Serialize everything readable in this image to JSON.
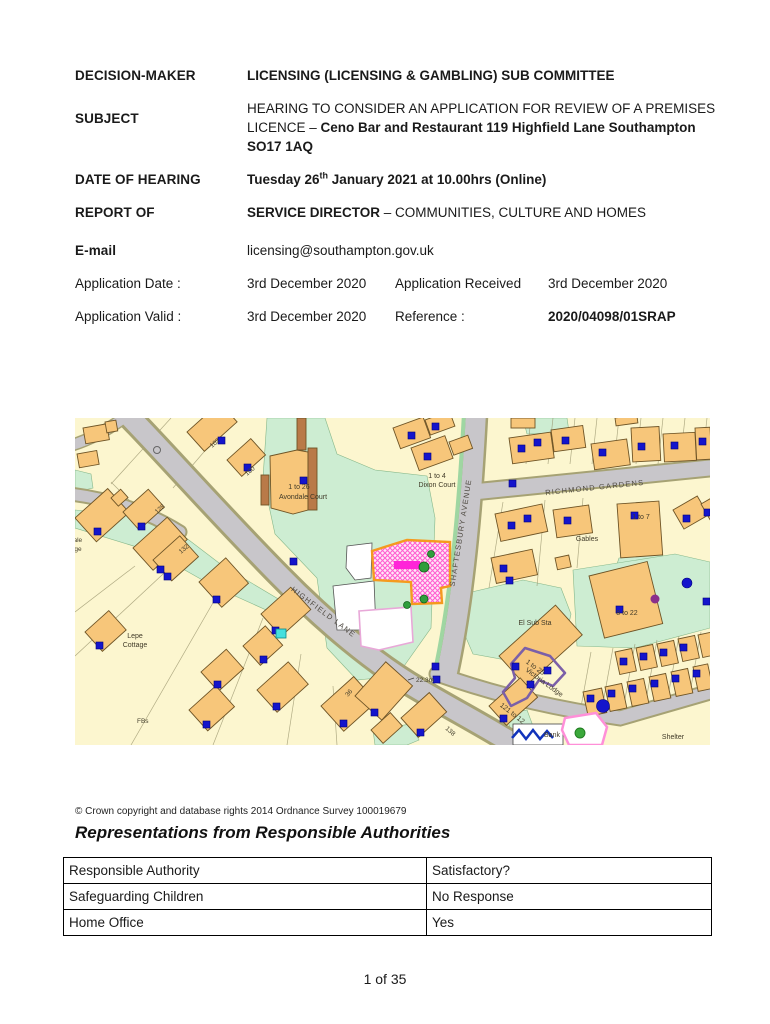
{
  "header": {
    "decision_maker_label": "DECISION-MAKER",
    "decision_maker_value": "LICENSING (LICENSING & GAMBLING) SUB COMMITTEE",
    "subject_label": "SUBJECT",
    "subject_value_regular": "HEARING TO CONSIDER AN APPLICATION FOR REVIEW OF A PREMISES LICENCE – ",
    "subject_value_bold": "Ceno Bar and Restaurant 119 Highfield Lane Southampton SO17 1AQ",
    "date_label": "DATE OF HEARING",
    "date_value_main": "Tuesday 26",
    "date_value_sup": "th",
    "date_value_rest": " January 2021 at 10.00hrs (Online)",
    "report_label": "REPORT OF",
    "report_value_bold": "SERVICE DIRECTOR",
    "report_value_regular": " – COMMUNITIES, CULTURE AND HOMES",
    "email_label": "E-mail",
    "email_value": "licensing@southampton.gov.uk",
    "app_date_label": "Application Date :",
    "app_date_value": "3rd December 2020",
    "app_received_label": "Application Received",
    "app_received_value": "3rd December 2020",
    "app_valid_label": "Application Valid :",
    "app_valid_value": "3rd December 2020",
    "reference_label": "Reference :",
    "reference_value": "2020/04098/01SRAP"
  },
  "map": {
    "copyright": "© Crown copyright and database rights 2014 Ordnance Survey 100019679",
    "colors": {
      "background": "#FCF6CF",
      "building": "#F7C67A",
      "road": "#C8C6CA",
      "green": "#CDEDD2",
      "marker_blue": "#1414CC",
      "premises_border": "#F59A1E",
      "premises_hatch": "#FF5FD0",
      "highlight_magenta": "#FF24D8"
    },
    "labels": {
      "richmond": "RICHMOND GARDENS",
      "shaftesbury": "SHAFTESBURY AVENUE",
      "highfield": "HIGHFIELD LANE",
      "avondale1": "1 to 26",
      "avondale2": "Avondale Court",
      "dixon1": "1 to 4",
      "dixon2": "Dixon Court",
      "gables": "Gables",
      "elsub": "El Sub Sta",
      "eight22": "8 to 22",
      "vic1": "1 to 25",
      "vic2": "Victoria Lodge",
      "v121": "121 to 12",
      "bank": "Bank",
      "shelter": "Shelter",
      "lepe1": "Lepe",
      "lepe2": "Cottage",
      "fbs": "FBs",
      "spot": "22.3m",
      "n102": "102",
      "n100": "100",
      "n128": "128",
      "n132": "132",
      "n36": "36",
      "n138": "138",
      "n1to7": "1 to 7",
      "cut1": "kvale",
      "cut2": "tage"
    }
  },
  "section": {
    "heading": "Representations from Responsible Authorities"
  },
  "table": {
    "rows": [
      [
        "Responsible Authority",
        "Satisfactory?"
      ],
      [
        "Safeguarding Children",
        "No Response"
      ],
      [
        "Home Office",
        "Yes"
      ]
    ]
  },
  "footer": {
    "page": "1 of 35"
  }
}
